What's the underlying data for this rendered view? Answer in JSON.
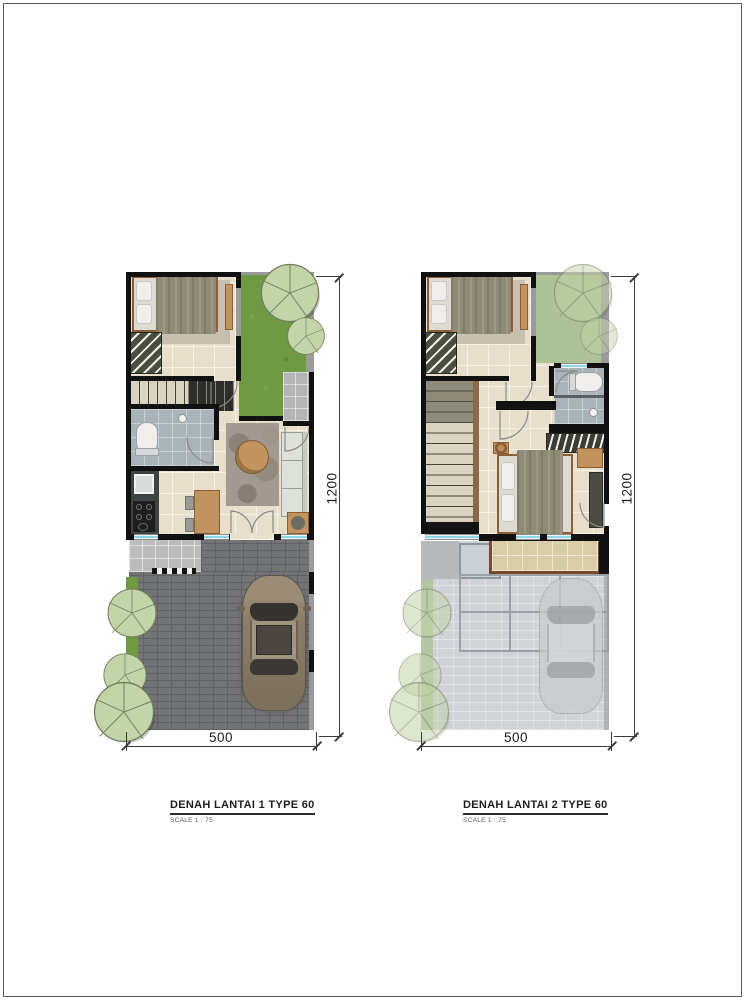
{
  "plans": [
    {
      "id": "lantai-1",
      "title": "DENAH LANTAI 1 TYPE 60",
      "scale_label": "SCALE 1 :  75",
      "dim_width": "500",
      "dim_height": "1200"
    },
    {
      "id": "lantai-2",
      "title": "DENAH LANTAI 2 TYPE 60",
      "scale_label": "SCALE 1 :  75",
      "dim_width": "500",
      "dim_height": "1200"
    }
  ],
  "colors": {
    "wall": "#111111",
    "gray-wall": "#9b9b9b",
    "floor": "#e7dfcc",
    "floor-line": "#f6f1e4",
    "grass": "#6f9a43",
    "grass-faded": "#adc296",
    "tree-fill": "#c3d4a9",
    "tree-line": "#6f7f5e",
    "porch": "#b5b5b6",
    "paver": "#737476",
    "paver-line": "#606164",
    "bath": "#a9b3ba",
    "counter": "#3e4346",
    "appliance": "#1e1e1e",
    "wood": "#c2935f",
    "wood-dark": "#8a5f38",
    "mattress": "#dedad1",
    "pillow": "#efeeec",
    "blanket": "#8e8a76",
    "sofa": "#dde1d7",
    "sofa-line": "#9aa096",
    "rug": "#a29a90",
    "rug-bed": "#c7c0b1",
    "window": "#8fd6e4",
    "window-frame": "#8c8c8c",
    "wardrobe": "#4a4e3e",
    "stairs": "#d9d3c1",
    "stairs-dark": "#6b6b5d",
    "terrace": "#bcbcbd",
    "balcony": "#d9cda7",
    "balcony-edge": "#7a4a2c",
    "faded": "#cfd3d7",
    "canopy": "#9aa1a7",
    "car-body": "#8d7e69",
    "car-glass": "#343330",
    "car-roof": "#a2957f",
    "ghost": "#c9cbcd",
    "ghost-glass": "#999da0",
    "dim": "#3a3a3a",
    "text": "#1d1d1d",
    "muted": "#555555",
    "sheet-border": "#5a5a5a"
  }
}
